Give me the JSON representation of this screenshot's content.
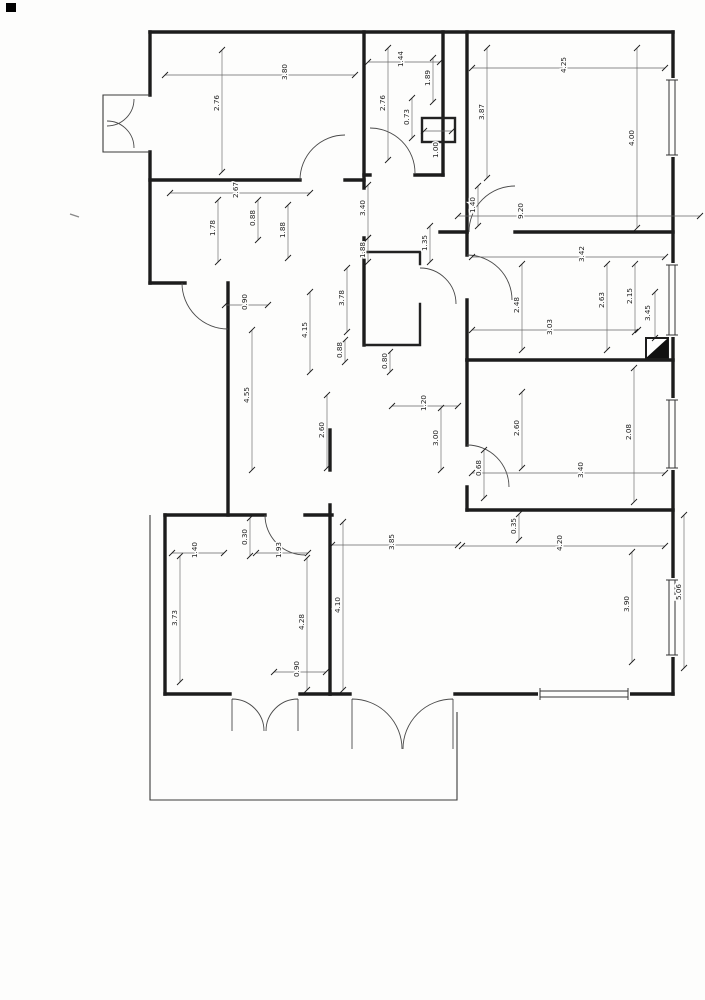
{
  "page": {
    "background": "#fdfdfc"
  },
  "drawing": {
    "ink_color": "#1c1c1c",
    "dim_line_color": "#666666",
    "label_color": "#222222",
    "shaft_fill": "#111111",
    "dimensions": [
      {
        "value": "3.80",
        "x1": 165,
        "y1": 75,
        "x2": 355,
        "y2": 75,
        "lx": 287,
        "ly": 72
      },
      {
        "value": "2.76",
        "x1": 222,
        "y1": 50,
        "x2": 222,
        "y2": 172,
        "lx": 219,
        "ly": 103
      },
      {
        "value": "2.67",
        "x1": 170,
        "y1": 193,
        "x2": 310,
        "y2": 193,
        "lx": 238,
        "ly": 190
      },
      {
        "value": "1.78",
        "x1": 218,
        "y1": 200,
        "x2": 218,
        "y2": 262,
        "lx": 215,
        "ly": 228
      },
      {
        "value": "0.88",
        "x1": 258,
        "y1": 200,
        "x2": 258,
        "y2": 240,
        "lx": 255,
        "ly": 218
      },
      {
        "value": "1.88",
        "x1": 288,
        "y1": 205,
        "x2": 288,
        "y2": 258,
        "lx": 285,
        "ly": 230
      },
      {
        "value": "0.90",
        "x1": 225,
        "y1": 305,
        "x2": 268,
        "y2": 305,
        "lx": 247,
        "ly": 302
      },
      {
        "value": "4.55",
        "x1": 252,
        "y1": 330,
        "x2": 252,
        "y2": 470,
        "lx": 249,
        "ly": 395
      },
      {
        "value": "4.15",
        "x1": 310,
        "y1": 292,
        "x2": 310,
        "y2": 372,
        "lx": 307,
        "ly": 330
      },
      {
        "value": "3.78",
        "x1": 347,
        "y1": 268,
        "x2": 347,
        "y2": 332,
        "lx": 344,
        "ly": 298
      },
      {
        "value": "0.88",
        "x1": 345,
        "y1": 340,
        "x2": 345,
        "y2": 362,
        "lx": 342,
        "ly": 350
      },
      {
        "value": "2.60",
        "x1": 327,
        "y1": 395,
        "x2": 327,
        "y2": 468,
        "lx": 324,
        "ly": 430
      },
      {
        "value": "1.20",
        "x1": 392,
        "y1": 406,
        "x2": 458,
        "y2": 406,
        "lx": 426,
        "ly": 403
      },
      {
        "value": "3.00",
        "x1": 441,
        "y1": 408,
        "x2": 441,
        "y2": 470,
        "lx": 438,
        "ly": 438
      },
      {
        "value": "3.85",
        "x1": 332,
        "y1": 545,
        "x2": 458,
        "y2": 545,
        "lx": 394,
        "ly": 542
      },
      {
        "value": "1.44",
        "x1": 368,
        "y1": 62,
        "x2": 440,
        "y2": 62,
        "lx": 403,
        "ly": 59
      },
      {
        "value": "1.89",
        "x1": 433,
        "y1": 58,
        "x2": 433,
        "y2": 102,
        "lx": 430,
        "ly": 78
      },
      {
        "value": "2.76",
        "x1": 388,
        "y1": 48,
        "x2": 388,
        "y2": 160,
        "lx": 385,
        "ly": 103
      },
      {
        "value": "0.73",
        "x1": 412,
        "y1": 98,
        "x2": 412,
        "y2": 138,
        "lx": 409,
        "ly": 117
      },
      {
        "value": "1.00",
        "x1": 424,
        "y1": 131,
        "x2": 452,
        "y2": 131,
        "lx": 438,
        "ly": 150
      },
      {
        "value": "4.25",
        "x1": 472,
        "y1": 68,
        "x2": 665,
        "y2": 68,
        "lx": 566,
        "ly": 65
      },
      {
        "value": "4.00",
        "x1": 637,
        "y1": 48,
        "x2": 637,
        "y2": 228,
        "lx": 634,
        "ly": 138
      },
      {
        "value": "3.87",
        "x1": 487,
        "y1": 48,
        "x2": 487,
        "y2": 178,
        "lx": 484,
        "ly": 112
      },
      {
        "value": "9.20",
        "x1": 458,
        "y1": 216,
        "x2": 700,
        "y2": 216,
        "lx": 523,
        "ly": 211
      },
      {
        "value": "1.40",
        "x1": 478,
        "y1": 186,
        "x2": 478,
        "y2": 226,
        "lx": 475,
        "ly": 205
      },
      {
        "value": "3.40",
        "x1": 368,
        "y1": 185,
        "x2": 368,
        "y2": 238,
        "lx": 365,
        "ly": 208
      },
      {
        "value": "1.88",
        "x1": 368,
        "y1": 238,
        "x2": 368,
        "y2": 262,
        "lx": 365,
        "ly": 250
      },
      {
        "value": "1.35",
        "x1": 430,
        "y1": 226,
        "x2": 430,
        "y2": 262,
        "lx": 427,
        "ly": 243
      },
      {
        "value": "0.80",
        "x1": 390,
        "y1": 352,
        "x2": 390,
        "y2": 372,
        "lx": 387,
        "ly": 361
      },
      {
        "value": "3.42",
        "x1": 472,
        "y1": 257,
        "x2": 665,
        "y2": 257,
        "lx": 584,
        "ly": 254
      },
      {
        "value": "2.48",
        "x1": 522,
        "y1": 264,
        "x2": 522,
        "y2": 350,
        "lx": 519,
        "ly": 305
      },
      {
        "value": "3.03",
        "x1": 472,
        "y1": 330,
        "x2": 638,
        "y2": 330,
        "lx": 552,
        "ly": 327
      },
      {
        "value": "2.63",
        "x1": 607,
        "y1": 264,
        "x2": 607,
        "y2": 350,
        "lx": 604,
        "ly": 300
      },
      {
        "value": "2.15",
        "x1": 635,
        "y1": 264,
        "x2": 635,
        "y2": 332,
        "lx": 632,
        "ly": 296
      },
      {
        "value": "3.45",
        "x1": 655,
        "y1": 292,
        "x2": 655,
        "y2": 338,
        "lx": 650,
        "ly": 313
      },
      {
        "value": "2.60",
        "x1": 522,
        "y1": 392,
        "x2": 522,
        "y2": 468,
        "lx": 519,
        "ly": 428
      },
      {
        "value": "2.08",
        "x1": 634,
        "y1": 368,
        "x2": 634,
        "y2": 502,
        "lx": 631,
        "ly": 432
      },
      {
        "value": "3.40",
        "x1": 472,
        "y1": 473,
        "x2": 665,
        "y2": 473,
        "lx": 583,
        "ly": 470
      },
      {
        "value": "0.68",
        "x1": 484,
        "y1": 450,
        "x2": 484,
        "y2": 498,
        "lx": 481,
        "ly": 468
      },
      {
        "value": "4.20",
        "x1": 462,
        "y1": 546,
        "x2": 665,
        "y2": 546,
        "lx": 562,
        "ly": 543
      },
      {
        "value": "0.35",
        "x1": 519,
        "y1": 514,
        "x2": 519,
        "y2": 540,
        "lx": 516,
        "ly": 526
      },
      {
        "value": "3.90",
        "x1": 632,
        "y1": 552,
        "x2": 632,
        "y2": 662,
        "lx": 629,
        "ly": 604
      },
      {
        "value": "5.06",
        "x1": 684,
        "y1": 515,
        "x2": 684,
        "y2": 668,
        "lx": 681,
        "ly": 592
      },
      {
        "value": "3.73",
        "x1": 180,
        "y1": 556,
        "x2": 180,
        "y2": 682,
        "lx": 177,
        "ly": 618
      },
      {
        "value": "1.40",
        "x1": 172,
        "y1": 553,
        "x2": 224,
        "y2": 553,
        "lx": 197,
        "ly": 550
      },
      {
        "value": "0.30",
        "x1": 250,
        "y1": 518,
        "x2": 250,
        "y2": 556,
        "lx": 247,
        "ly": 537
      },
      {
        "value": "1.93",
        "x1": 256,
        "y1": 553,
        "x2": 308,
        "y2": 553,
        "lx": 281,
        "ly": 550
      },
      {
        "value": "4.28",
        "x1": 307,
        "y1": 558,
        "x2": 307,
        "y2": 690,
        "lx": 304,
        "ly": 622
      },
      {
        "value": "4.10",
        "x1": 343,
        "y1": 522,
        "x2": 343,
        "y2": 690,
        "lx": 340,
        "ly": 605
      },
      {
        "value": "0.90",
        "x1": 274,
        "y1": 672,
        "x2": 326,
        "y2": 672,
        "lx": 299,
        "ly": 669
      }
    ]
  }
}
